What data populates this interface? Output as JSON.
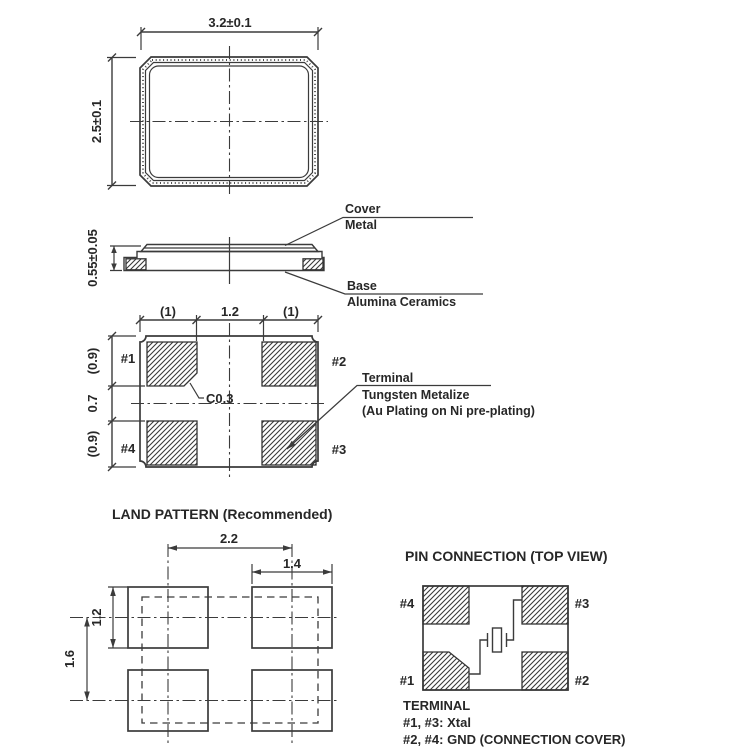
{
  "colors": {
    "line": "#3b3b3b",
    "text": "#272727",
    "background": "#ffffff"
  },
  "top_view": {
    "width_dim": "3.2±0.1",
    "height_dim": "2.5±0.1"
  },
  "side_view": {
    "height_dim": "0.55±0.05",
    "cover_line1": "Cover",
    "cover_line2": "Metal",
    "base_line1": "Base",
    "base_line2": "Alumina Ceramics"
  },
  "bottom_view": {
    "dims_top": {
      "left": "(1)",
      "center": "1.2",
      "right": "(1)"
    },
    "dims_left": {
      "top": "(0.9)",
      "middle": "0.7",
      "bottom": "(0.9)"
    },
    "pins": {
      "p1": "#1",
      "p2": "#2",
      "p3": "#3",
      "p4": "#4"
    },
    "chamfer_label": "C0.3",
    "note_line1": "Terminal",
    "note_line2": "Tungsten Metalize",
    "note_line3": "(Au Plating on Ni pre-plating)"
  },
  "land_pattern": {
    "title": "LAND PATTERN (Recommended)",
    "dim_spacing_x": "2.2",
    "dim_pad_width": "1.4",
    "dim_pad_height": "1.2",
    "dim_spacing_y": "1.6"
  },
  "pin_connection": {
    "title": "PIN CONNECTION (TOP VIEW)",
    "pins": {
      "p1": "#1",
      "p2": "#2",
      "p3": "#3",
      "p4": "#4"
    },
    "legend_title": "TERMINAL",
    "legend_line1": "#1, #3: Xtal",
    "legend_line2": "#2, #4: GND (CONNECTION COVER)"
  }
}
